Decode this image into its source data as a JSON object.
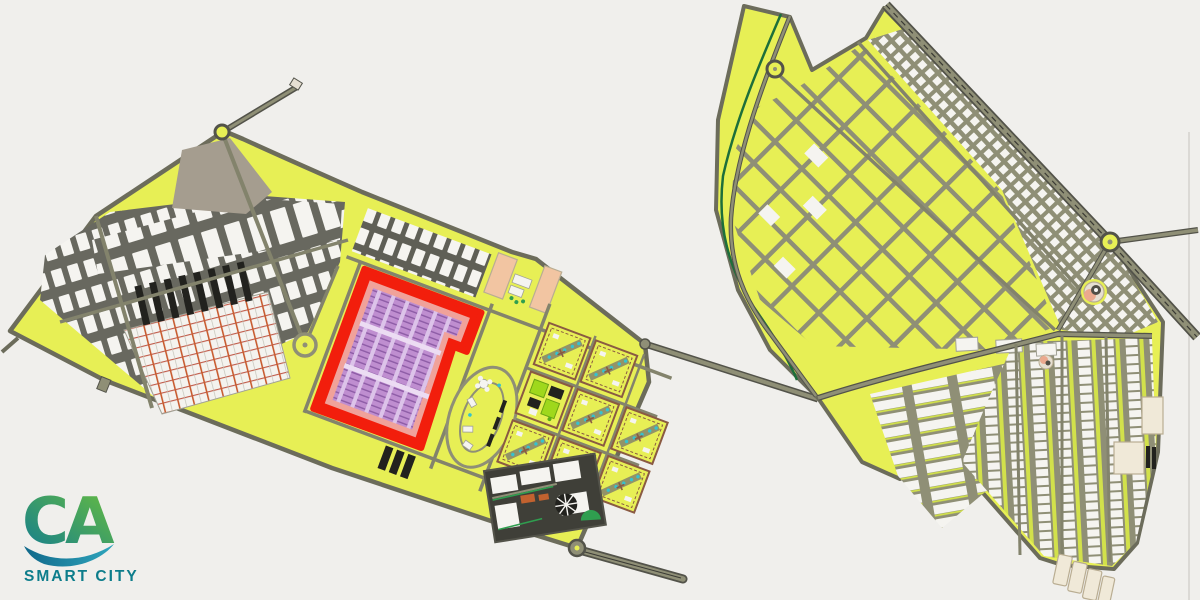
{
  "logo": {
    "mark": "CA",
    "label": "SMART CITY"
  },
  "palette": {
    "bg": "#f0efec",
    "estateYellow": "#e7ef55",
    "roadOlive": "#8f8f76",
    "roadCase": "#53534a",
    "roadMinor": "#83836c",
    "boundary": "#6c6c5b",
    "roadDark": "#68685f",
    "bandDark": "#5f5f56",
    "plotWhite": "#f5f4f0",
    "plotStroke": "#a2a296",
    "taupe": "#a59d8f",
    "industrialBg": "#f4f3ef",
    "industrialOrange": "#c85c30",
    "industrialRed": "#c05a48",
    "industrialGrid": "#c3c3b8",
    "barsDark": "#22221e",
    "redBorder": "#f21e0c",
    "redMargin": "#f0a29a",
    "purpleBase": "#dcc3e9",
    "purpleCol": "#bf8ed0",
    "purpleFloor": "#8d5ca6",
    "purpleLane": "#ecdcf3",
    "peach": "#f2c5a2",
    "parkGreen": "#9fd81c",
    "parkDark": "#5aab1a",
    "parkEdge": "#6aa313",
    "tealDot": "#35c3ce",
    "canalGreen": "#1d6f3a",
    "cream": "#f0e9d8",
    "creamStroke": "#b9ad92",
    "commercialDark": "#3f3f38",
    "commercialOrange": "#c2622f",
    "commercialGreen": "#2f9e4f",
    "brown": "#8a5a42",
    "salmon": "#eba98e",
    "domeDark": "#514e45",
    "stone": "#e6dfd2",
    "greenStrip": "#d2e14b",
    "artifactLine": "#dbd9d5",
    "logoTeal": "#0f7a93",
    "logoGreen": "#6abf3c",
    "logoBlueA": "#11688a",
    "logoBlueB": "#2fa6bd",
    "logoText": "#0d7d8b"
  },
  "regions": [
    {
      "id": "west-estate",
      "fill": "#e7ef55"
    },
    {
      "id": "red-highlight-zone",
      "fill": "#f21e0c"
    },
    {
      "id": "purple-housing-zone",
      "fill": "#bf8ed0"
    },
    {
      "id": "industrial-grid",
      "fill": "#f4f3ef"
    },
    {
      "id": "central-apartment-blocks",
      "fill": "#e7ef55"
    },
    {
      "id": "commercial-zone",
      "fill": "#3f3f38"
    },
    {
      "id": "east-estate",
      "fill": "#e7ef55"
    },
    {
      "id": "canal",
      "fill": "#1d6f3a"
    }
  ]
}
